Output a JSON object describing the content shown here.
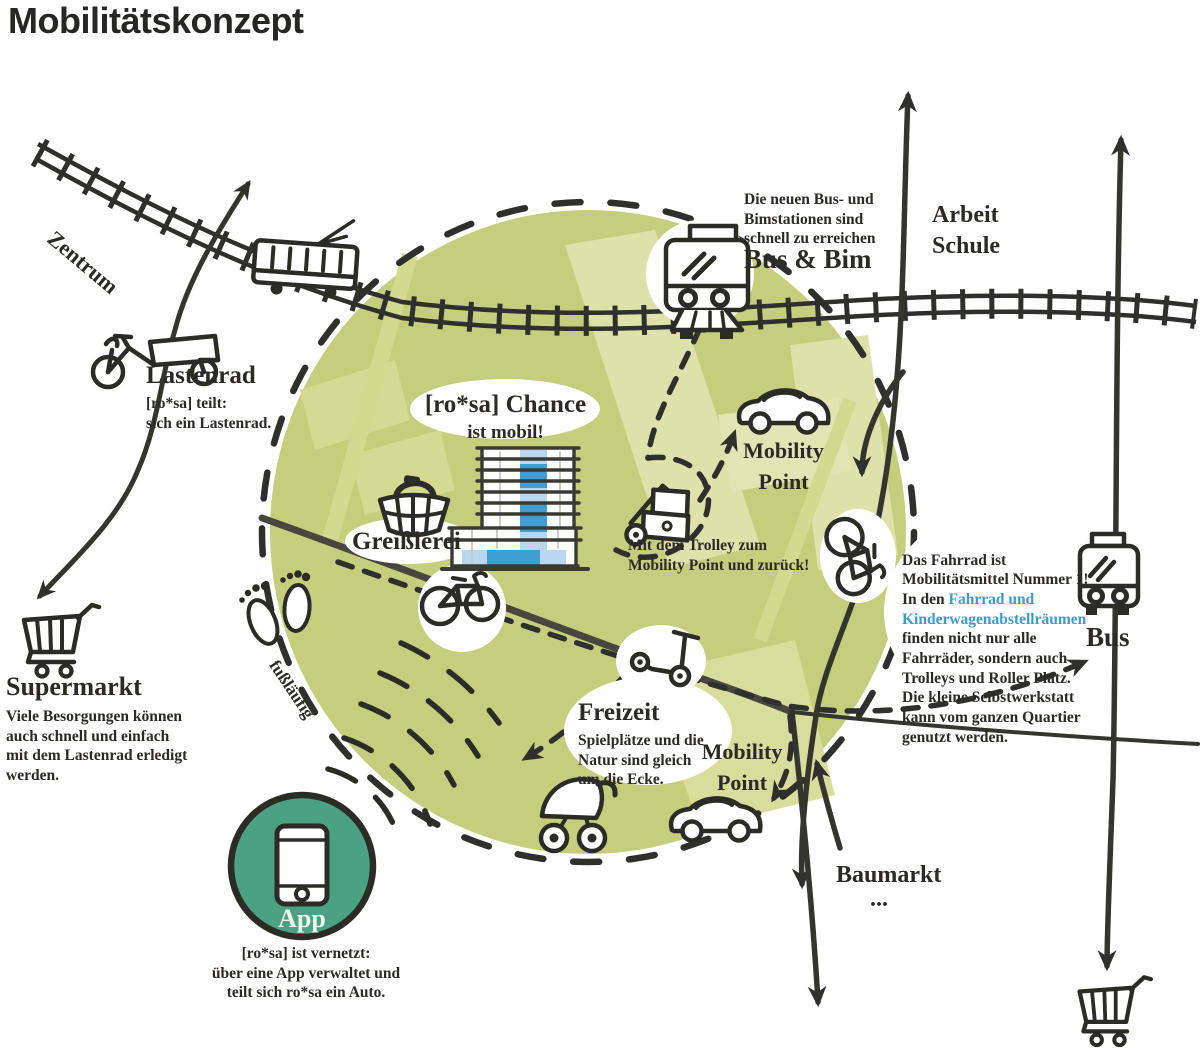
{
  "title": "Mobilitätskonzept",
  "colors": {
    "circle_green": "#c3cf7c",
    "patch_green": "#d3db93",
    "pale_green": "#dce2a9",
    "ink": "#2f2f2d",
    "road_grey": "#46463e",
    "link_blue": "#3d9bce",
    "building_blue_light": "#b9d7ee",
    "building_blue": "#3f9fd3",
    "app_green": "#4ba183"
  },
  "labels": {
    "zentrum": "Zentrum",
    "fusslaeufig": "fußläufig",
    "arbeit_schule": "Arbeit\nSchule",
    "bus": "Bus",
    "baumarkt": "Baumarkt",
    "baumarkt_dots": "...",
    "mobility_point_top": "Mobility\nPoint",
    "mobility_point_bottom": "Mobility\nPoint"
  },
  "blocks": {
    "lastenrad": {
      "heading": "Lastenrad",
      "body": "[ro*sa] teilt:\nsich ein Lastenrad."
    },
    "supermarkt": {
      "heading": "Supermarkt",
      "body": "Viele Besorgungen können\nauch schnell und einfach\nmit dem Lastenrad erledigt\nwerden."
    },
    "bus_bim": {
      "note": "Die neuen Bus- und\nBimstationen sind\nschnell zu erreichen",
      "heading": "Bus & Bim"
    },
    "rosa_chance": {
      "heading": "[ro*sa] Chance",
      "sub": "ist mobil!"
    },
    "greisslerei": {
      "heading": "Greißlerei"
    },
    "trolley": {
      "note": "Mit dem Trolley zum\nMobility Point und zurück!"
    },
    "fahrrad": {
      "text_before": "Das Fahrrad ist\nMobilitätsmittel Nummer 1!\nIn den ",
      "text_link": "Fahrrad und\nKinderwagenabstellräumen",
      "text_after": "\nfinden nicht nur alle\nFahrräder, sondern auch\nTrolleys und Roller Platz.\nDie kleine Selbstwerkstatt\nkann vom ganzen Quartier\ngenutzt werden."
    },
    "freizeit": {
      "heading": "Freizeit",
      "body": "Spielplätze und die\nNatur sind gleich\num die Ecke."
    },
    "app": {
      "label": "App",
      "note": "[ro*sa] ist vernetzt:\nüber eine App verwaltet und\nteilt sich ro*sa ein Auto."
    }
  },
  "icons": [
    "tram-side-icon",
    "tram-front-icon",
    "bus-front-icon",
    "cargo-bike-icon",
    "shopping-cart-icon",
    "shopping-basket-icon",
    "building-icon",
    "bicycle-icon",
    "vertical-bicycle-icon",
    "trolley-icon",
    "car-icon",
    "pram-icon",
    "kick-scooter-icon",
    "footprints-icon",
    "smartphone-icon",
    "wifi-arcs-icon"
  ]
}
